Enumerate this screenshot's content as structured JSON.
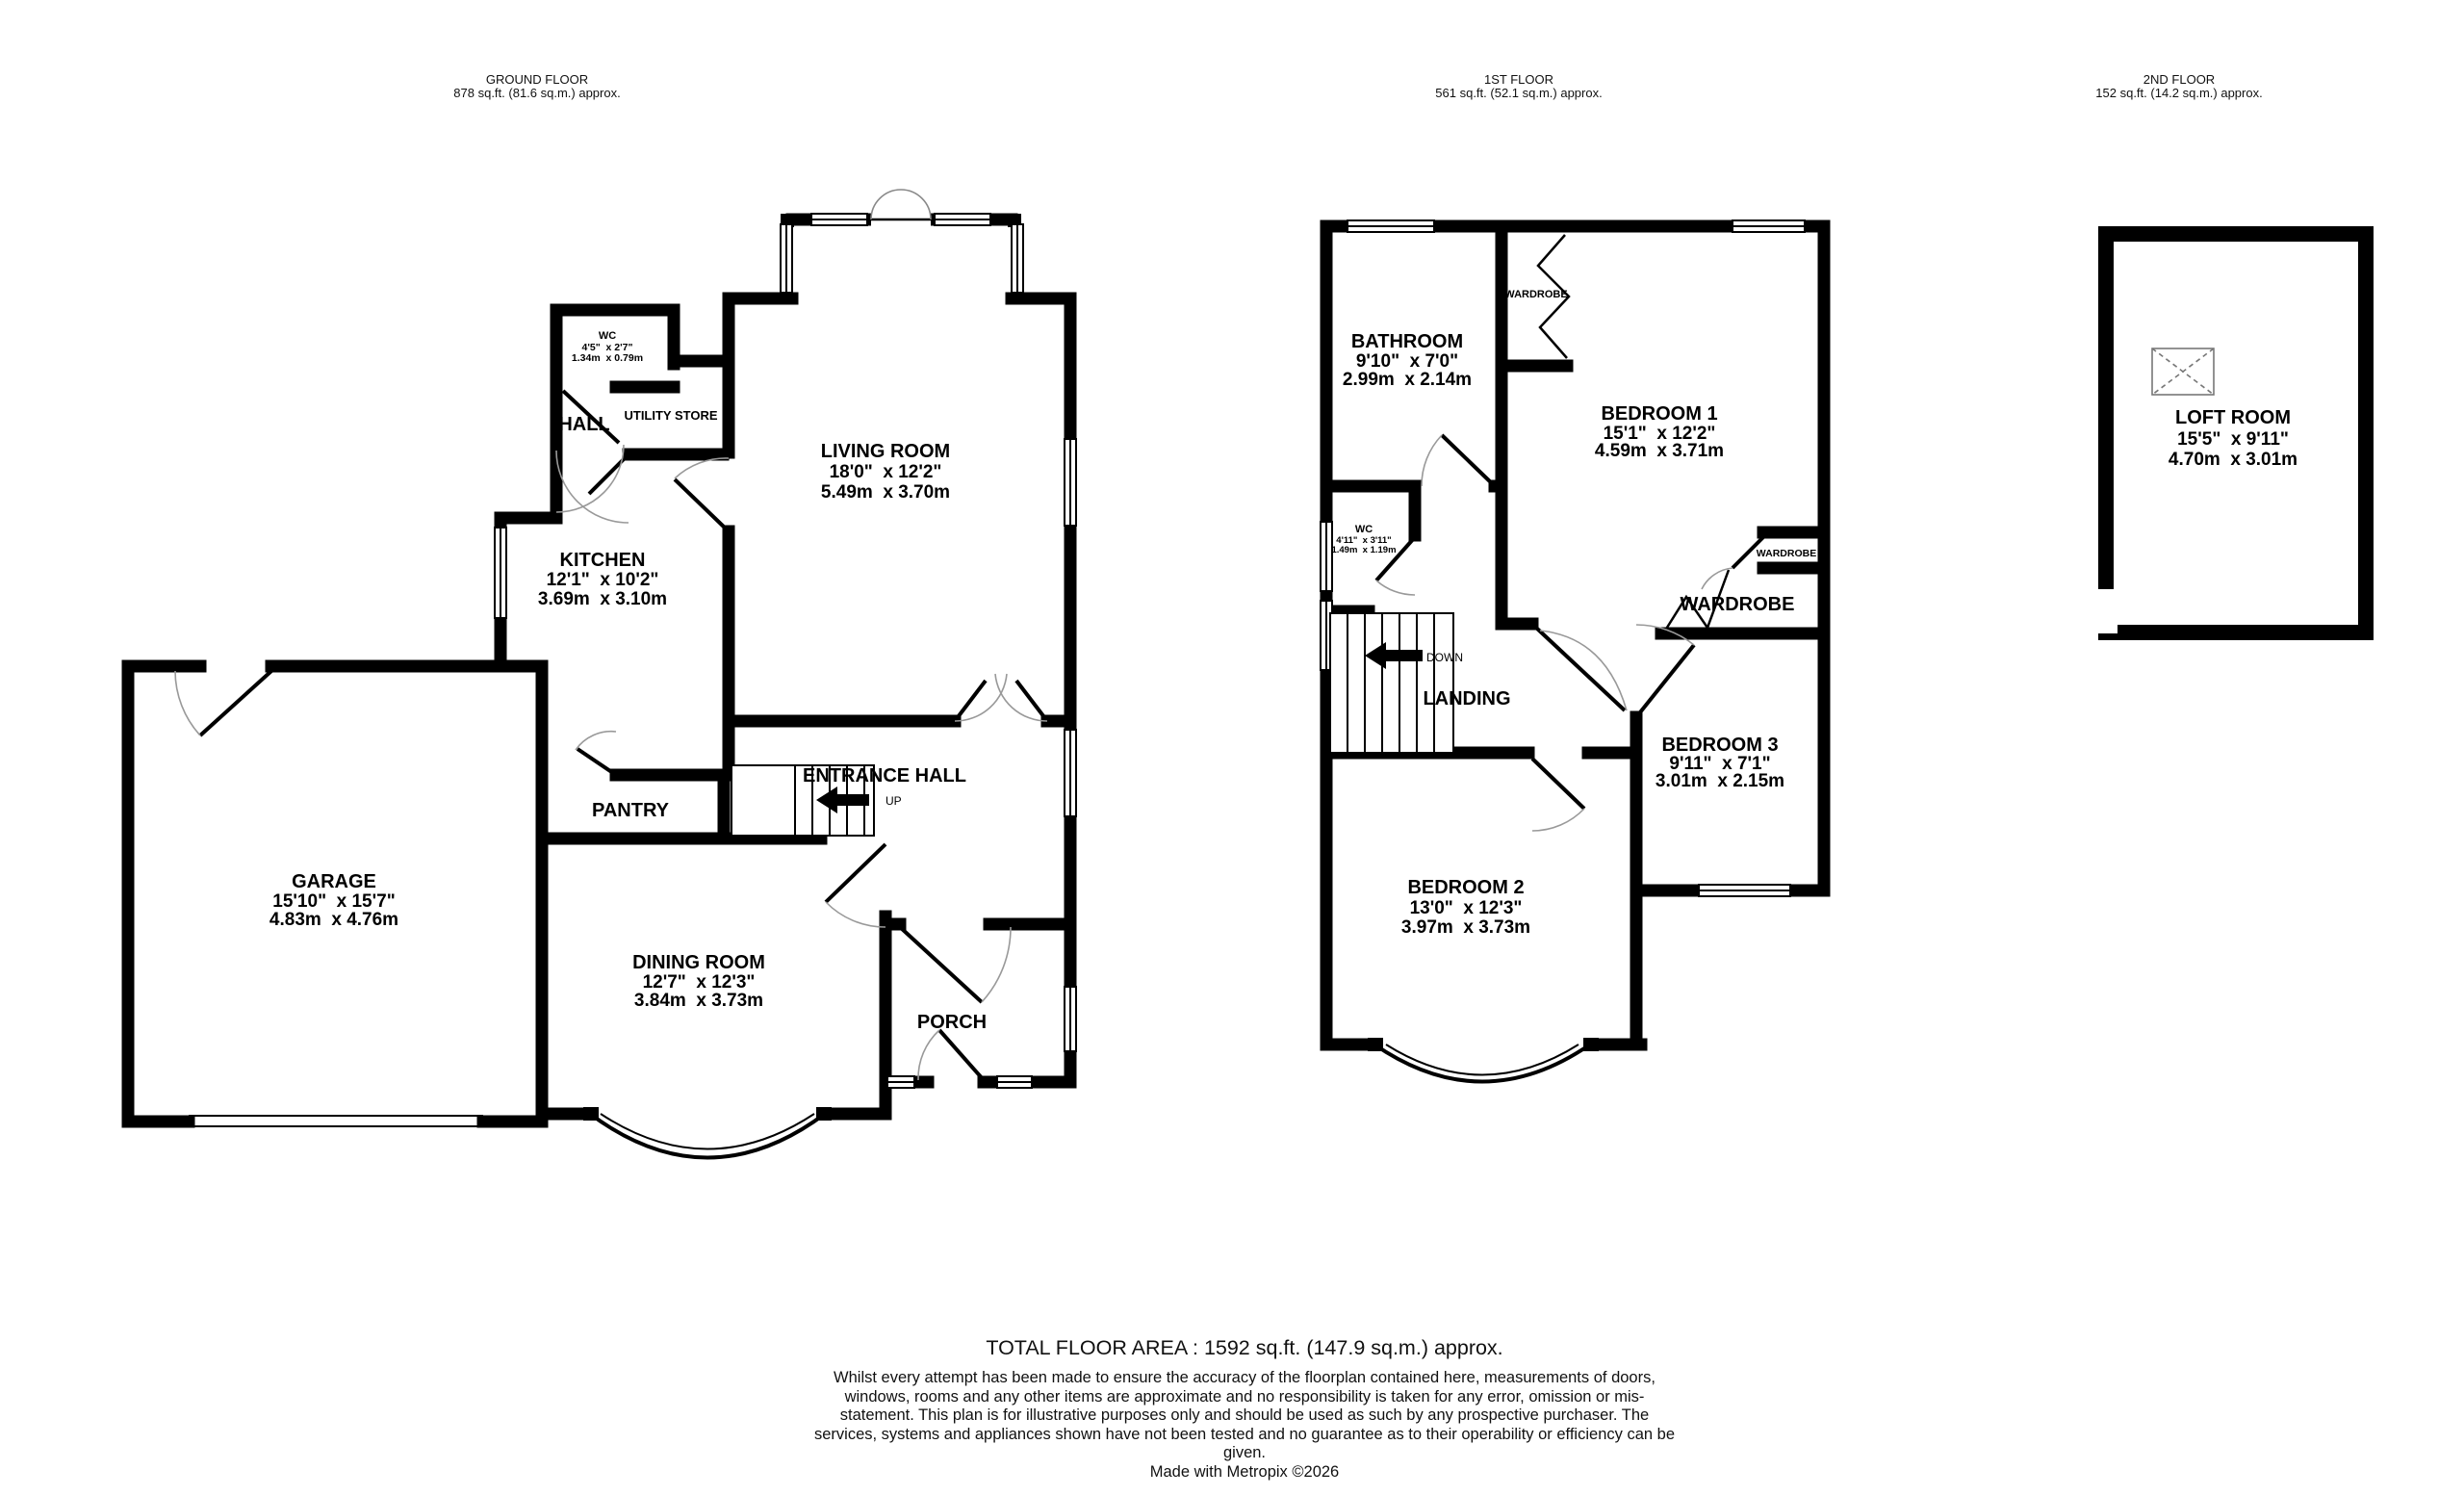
{
  "colors": {
    "wall": "#000000",
    "arc": "#999999",
    "background": "#ffffff"
  },
  "floors": {
    "ground": {
      "title": "GROUND FLOOR",
      "area": "878 sq.ft. (81.6 sq.m.) approx."
    },
    "first": {
      "title": "1ST FLOOR",
      "area": "561 sq.ft. (52.1 sq.m.) approx."
    },
    "second": {
      "title": "2ND FLOOR",
      "area": "152 sq.ft. (14.2 sq.m.) approx."
    }
  },
  "rooms": {
    "wc_ground": {
      "name": "WC",
      "imperial": "4'5\"  x 2'7\"",
      "metric": "1.34m  x 0.79m"
    },
    "hall": {
      "name": "HALL"
    },
    "utility_store": {
      "name": "UTILITY STORE"
    },
    "living_room": {
      "name": "LIVING ROOM",
      "imperial": "18'0\"  x 12'2\"",
      "metric": "5.49m  x 3.70m"
    },
    "kitchen": {
      "name": "KITCHEN",
      "imperial": "12'1\"  x 10'2\"",
      "metric": "3.69m  x 3.10m"
    },
    "garage": {
      "name": "GARAGE",
      "imperial": "15'10\"  x 15'7\"",
      "metric": "4.83m  x 4.76m"
    },
    "pantry": {
      "name": "PANTRY"
    },
    "entrance_hall": {
      "name": "ENTRANCE HALL"
    },
    "dining_room": {
      "name": "DINING ROOM",
      "imperial": "12'7\"  x 12'3\"",
      "metric": "3.84m  x 3.73m"
    },
    "porch": {
      "name": "PORCH"
    },
    "bathroom": {
      "name": "BATHROOM",
      "imperial": "9'10\"  x 7'0\"",
      "metric": "2.99m  x 2.14m"
    },
    "bedroom1": {
      "name": "BEDROOM 1",
      "imperial": "15'1\"  x 12'2\"",
      "metric": "4.59m  x 3.71m"
    },
    "bedroom2": {
      "name": "BEDROOM 2",
      "imperial": "13'0\"  x 12'3\"",
      "metric": "3.97m  x 3.73m"
    },
    "bedroom3": {
      "name": "BEDROOM 3",
      "imperial": "9'11\"  x 7'1\"",
      "metric": "3.01m  x 2.15m"
    },
    "wc_first": {
      "name": "WC",
      "imperial": "4'11\"  x 3'11\"",
      "metric": "1.49m  x 1.19m"
    },
    "landing": {
      "name": "LANDING"
    },
    "wardrobe_bedroom1": {
      "name": "WARDROBE"
    },
    "wardrobe_small": {
      "name": "WARDROBE"
    },
    "wardrobe_large": {
      "name": "WARDROBE"
    },
    "loft_room": {
      "name": "LOFT ROOM",
      "imperial": "15'5\"  x 9'11\"",
      "metric": "4.70m  x 3.01m"
    }
  },
  "stairs": {
    "up_label": "UP",
    "down_label": "DOWN"
  },
  "footer": {
    "total_area": "TOTAL FLOOR AREA : 1592 sq.ft. (147.9 sq.m.) approx.",
    "disclaimer": "Whilst every attempt has been made to ensure the accuracy of the floorplan contained here, measurements of doors, windows, rooms and any other items are approximate and no responsibility is taken for any error, omission or mis-statement. This plan is for illustrative purposes only and should be used as such by any prospective purchaser. The services, systems and appliances shown have not been tested and no guarantee as to their operability or efficiency can be given.",
    "credit": "Made with Metropix ©2026"
  }
}
